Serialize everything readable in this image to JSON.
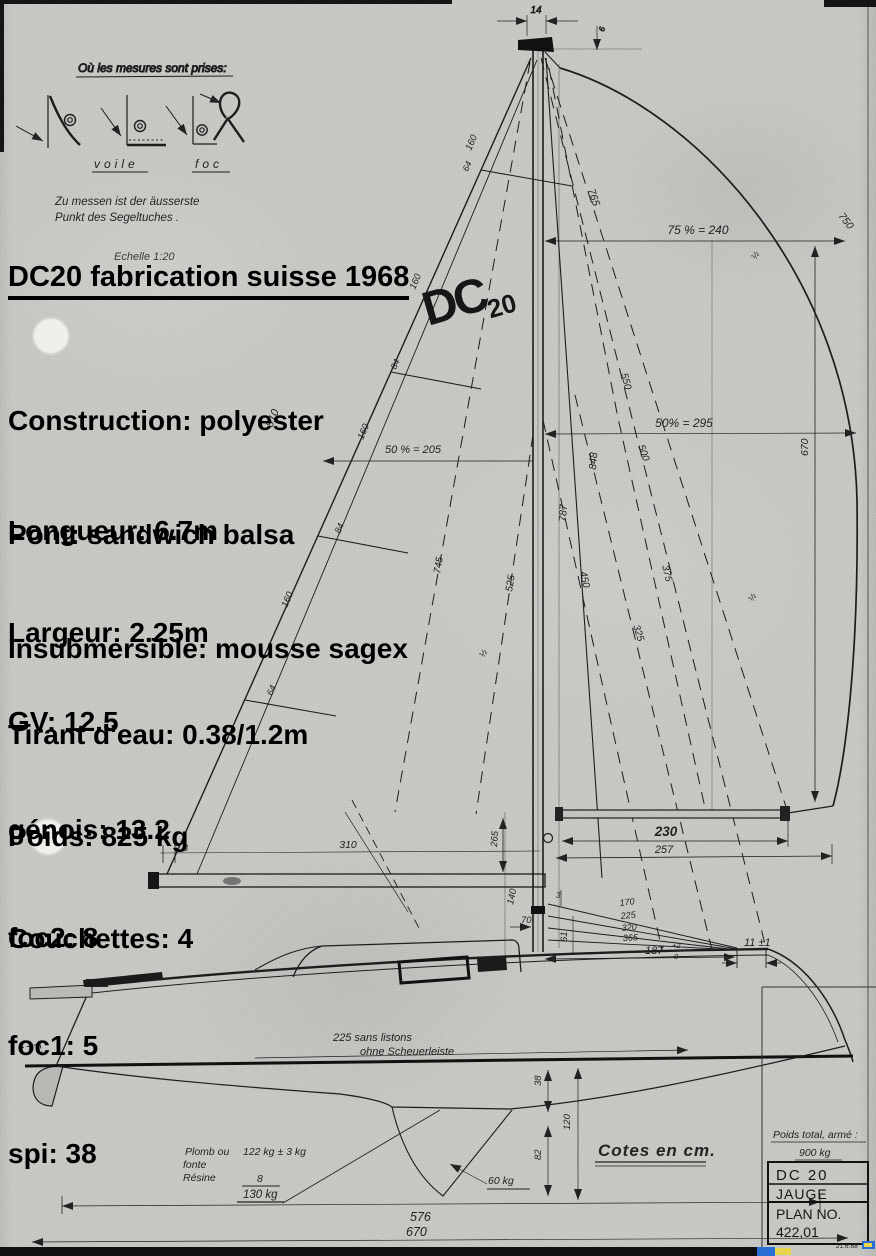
{
  "legend": {
    "title": "Où les mesures sont prises:",
    "voile": "voile",
    "foc": "foc",
    "note1": "Zu messen ist der äusserste",
    "note2": "Punkt des Segeltuches .",
    "scale": "Echelle 1:20"
  },
  "overlay": {
    "title": "DC20 fabrication suisse 1968",
    "construction": [
      "Construction: polyester",
      "Pont: sandwich balsa",
      "Insubmersible: mousse sagex"
    ],
    "specs": [
      "Longueur: 6.7m",
      "Largeur: 2.25m",
      "Tirant d'eau: 0.38/1.2m",
      "Poids: 825 kg",
      "Couchettes: 4"
    ],
    "sails": [
      "GV: 12.5",
      "génois: 13.2",
      "foc2: 8",
      "foc1: 5",
      "spi: 38"
    ]
  },
  "logo": {
    "dc": "DC",
    "n20": "20"
  },
  "dims": {
    "d14": "14",
    "d6": "6",
    "d765": "765",
    "d750": "750",
    "w75": "75 % = 240",
    "w50": "50% = 295",
    "d550": "550",
    "d500": "500",
    "d670": "670",
    "half": "½",
    "d848": "848",
    "d787": "787",
    "d450": "450",
    "d375": "375",
    "d325": "325",
    "d810": "810",
    "d745": "745",
    "d525": "525",
    "w50main": "50 % = 205",
    "d160": "160",
    "d64": "64",
    "d84": "84",
    "d310": "310",
    "d3": "3",
    "d230": "230",
    "d257": "257",
    "d265": "265",
    "d140": "140",
    "d70": "70",
    "d61": "61",
    "fan0": "170",
    "fan1": "225",
    "fan2": "320",
    "fan3": "365",
    "d187": "187",
    "tolp": "+2",
    "tol0": "0",
    "d11": "11 ±1",
    "note225a": "225   sans listons",
    "note225b": "ohne Scheuerleiste",
    "d38": "38",
    "d82": "82",
    "d120": "120",
    "kg60": "60 kg",
    "d576": "576",
    "d670b": "670",
    "cotes": "Cotes en cm."
  },
  "ballast": {
    "l1": "Plomb ou",
    "l2": "fonte",
    "l3": "Résine",
    "w1": "122 kg ± 3 kg",
    "w2": "8",
    "total": "130 kg"
  },
  "title_block": {
    "weight_label": "Poids total, armé :",
    "weight_value": "900 kg",
    "row1": "DC 20",
    "row2": "JAUGE",
    "row3a": "PLAN  NO.",
    "row3b": "422,01",
    "date": "21.6.68"
  }
}
